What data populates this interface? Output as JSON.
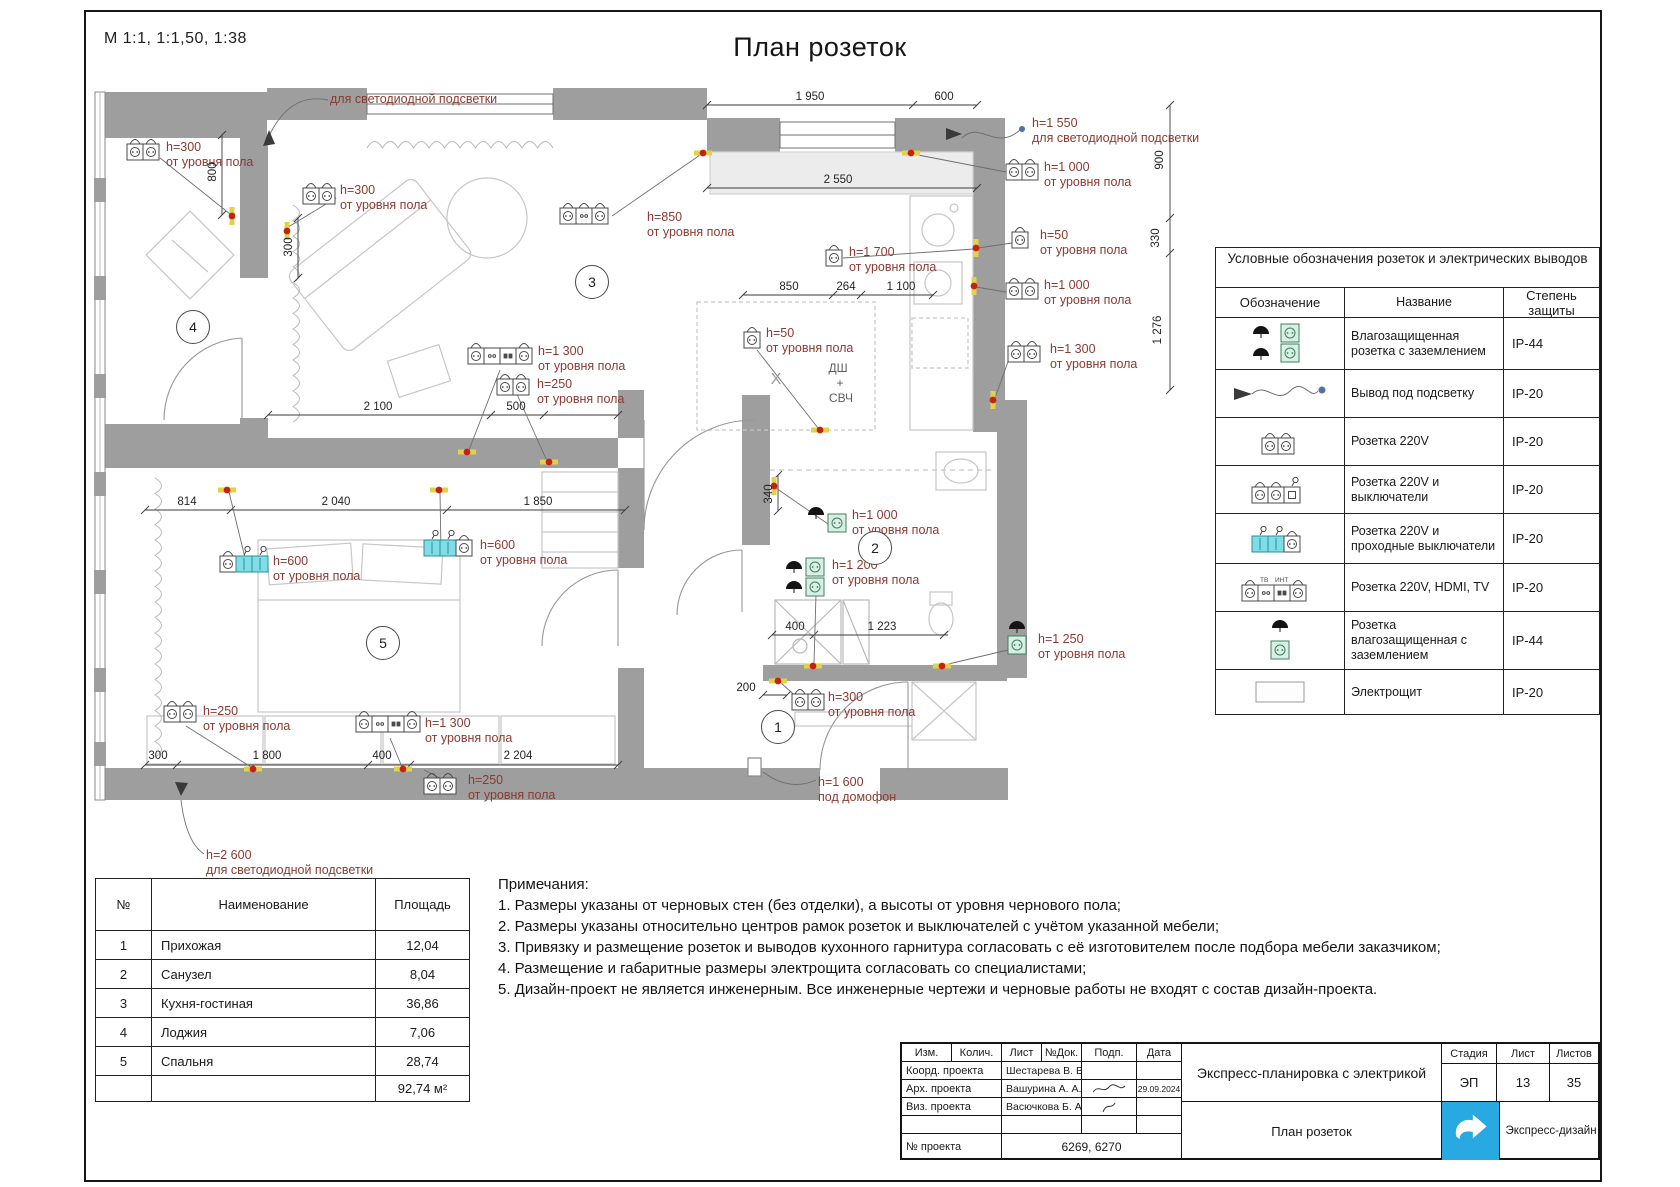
{
  "page": {
    "scale_note": "М 1:1, 1:1,50, 1:38",
    "title": "План розеток"
  },
  "plan": {
    "annotations": [
      {
        "h": "",
        "sub": "для светодиодной подсветки"
      },
      {
        "h": "h=300",
        "sub": "от уровня пола"
      },
      {
        "h": "h=300",
        "sub": "от уровня пола"
      },
      {
        "h": "h=850",
        "sub": "от уровня пола"
      },
      {
        "h": "h=1 550",
        "sub": "для светодиодной подсветки"
      },
      {
        "h": "h=1 000",
        "sub": "от уровня пола"
      },
      {
        "h": "h=50",
        "sub": "от уровня пола"
      },
      {
        "h": "h=1 700",
        "sub": "от уровня пола"
      },
      {
        "h": "h=1 000",
        "sub": "от уровня пола"
      },
      {
        "h": "h=1 300",
        "sub": "от уровня пола"
      },
      {
        "h": "h=50",
        "sub": "от уровня пола"
      },
      {
        "h": "h=1 300",
        "sub": "от уровня пола"
      },
      {
        "h": "h=250",
        "sub": "от уровня пола"
      },
      {
        "h": "h=1 000",
        "sub": "от уровня пола"
      },
      {
        "h": "h=1 200",
        "sub": "от уровня пола"
      },
      {
        "h": "h=1 250",
        "sub": "от уровня пола"
      },
      {
        "h": "h=300",
        "sub": "от уровня пола"
      },
      {
        "h": "h=600",
        "sub": "от уровня пола"
      },
      {
        "h": "h=600",
        "sub": "от уровня пола"
      },
      {
        "h": "h=250",
        "sub": "от уровня пола"
      },
      {
        "h": "h=1 300",
        "sub": "от уровня пола"
      },
      {
        "h": "h=250",
        "sub": "от уровня пола"
      },
      {
        "h": "h=1 600",
        "sub": "под домофон"
      },
      {
        "h": "h=2 600",
        "sub": "для светодиодной подсветки"
      }
    ],
    "dims": [
      "1 950",
      "600",
      "2 550",
      "900",
      "330",
      "1 276",
      "850",
      "264",
      "1 100",
      "800",
      "300",
      "2 100",
      "500",
      "814",
      "2 040",
      "1 850",
      "340",
      "400",
      "1 223",
      "200",
      "300",
      "1 800",
      "400",
      "2 204"
    ],
    "room_numbers": [
      "1",
      "2",
      "3",
      "4",
      "5"
    ],
    "kitchen": {
      "dw": "ДШ",
      "plus": "+",
      "mw": "СВЧ",
      "cross": "X"
    }
  },
  "legend": {
    "title": "Условные обозначения розеток и электрических выводов",
    "col_symbol": "Обозначение",
    "col_name": "Название",
    "col_ip": "Степень защиты",
    "icon_tags": {
      "tv": "ТВ",
      "int": "ИНТ"
    },
    "rows": [
      {
        "name": "Влагозащищенная розетка с заземлением",
        "ip": "IP-44"
      },
      {
        "name": "Вывод под подсветку",
        "ip": "IP-20"
      },
      {
        "name": "Розетка 220V",
        "ip": "IP-20"
      },
      {
        "name": "Розетка 220V и выключатели",
        "ip": "IP-20"
      },
      {
        "name": "Розетка 220V и проходные выключатели",
        "ip": "IP-20"
      },
      {
        "name": "Розетка 220V, HDMI, TV",
        "ip": "IP-20"
      },
      {
        "name": "Розетка влагозащищенная с заземлением",
        "ip": "IP-44"
      },
      {
        "name": "Электрощит",
        "ip": "IP-20"
      }
    ]
  },
  "rooms_table": {
    "col_no": "№",
    "col_name": "Наименование",
    "col_area": "Площадь",
    "rows": [
      {
        "no": "1",
        "name": "Прихожая",
        "area": "12,04"
      },
      {
        "no": "2",
        "name": "Санузел",
        "area": "8,04"
      },
      {
        "no": "3",
        "name": "Кухня-гостиная",
        "area": "36,86"
      },
      {
        "no": "4",
        "name": "Лоджия",
        "area": "7,06"
      },
      {
        "no": "5",
        "name": "Спальня",
        "area": "28,74"
      }
    ],
    "total": "92,74 м²"
  },
  "notes": {
    "title": "Примечания:",
    "items": [
      "1. Размеры указаны от черновых стен (без отделки), а высоты от уровня чернового пола;",
      "2. Размеры указаны относительно центров рамок розеток и выключателей с учётом указанной мебели;",
      "3. Привязку и размещение розеток и выводов кухонного гарнитура согласовать с её изготовителем после подбора мебели заказчиком;",
      "4. Размещение и габаритные размеры электрощита согласовать со специалистами;",
      "5. Дизайн-проект не является инженерным. Все инженерные чертежи и черновые работы не входят с состав дизайн-проекта."
    ]
  },
  "title_block": {
    "cols": {
      "izm": "Изм.",
      "kol": "Колич.",
      "list": "Лист",
      "ndok": "№Док.",
      "podp": "Подп.",
      "data": "Дата"
    },
    "rows": [
      {
        "label": "Коорд. проекта",
        "value": "Шестарева В. В.",
        "date": ""
      },
      {
        "label": "Арх. проекта",
        "value": "Вашурина А. А.",
        "date": "29.09.2024"
      },
      {
        "label": "Виз. проекта",
        "value": "Васючкова Б. А",
        "date": ""
      }
    ],
    "project_no_label": "№ проекта",
    "project_no": "6269, 6270",
    "doc_title": "Экспресс-планировка с электрикой",
    "sheet_title": "План розеток",
    "stage_label": "Стадия",
    "stage": "ЭП",
    "sheet_label": "Лист",
    "sheet": "13",
    "sheets_label": "Листов",
    "sheets": "35",
    "brand": "Экспресс-дизайн"
  }
}
